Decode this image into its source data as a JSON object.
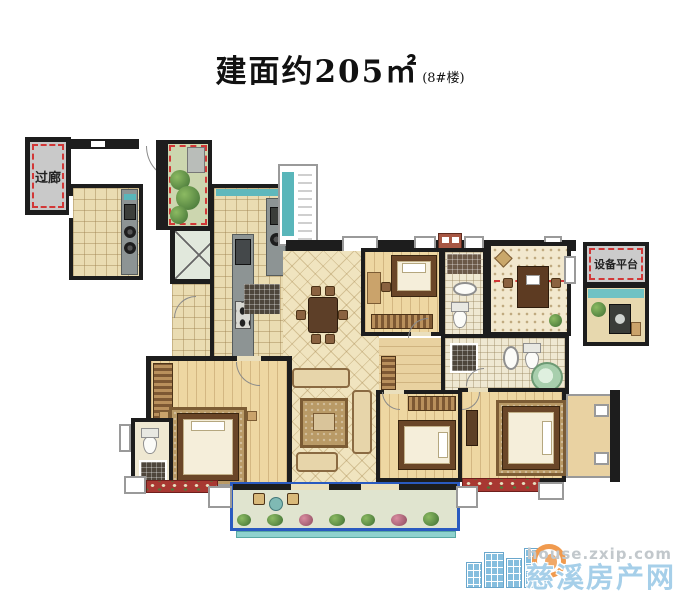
{
  "title": {
    "text": "建面约205㎡",
    "suffix": "(8#楼)"
  },
  "plan_labels": {
    "corridor": "过廊",
    "equipment_platform": "设备平台"
  },
  "watermark": {
    "site_url": "house.zxip.com",
    "site_name": "慈溪房产网"
  },
  "colors": {
    "wall": "#1d1d1d",
    "red_dashed": "#d23737",
    "corridor_fill": "#c9c9c9",
    "floor_tile": "#eadcb2",
    "floor_diamond": "#f0e4bf",
    "floor_wood": "#eed7a2",
    "garden_green": "#ccd6af",
    "water_teal": "#5fb8bc",
    "balcony_frame_blue": "#2a5ac0",
    "flower_box_red": "#a83832",
    "watermark_blue": "#a6cfe9",
    "watermark_gray": "#c2c8cc"
  }
}
